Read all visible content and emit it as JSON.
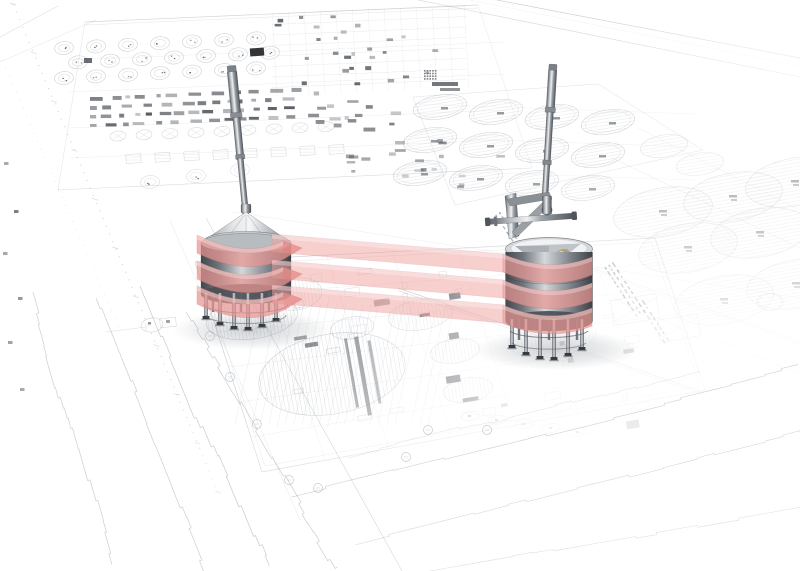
{
  "scene": {
    "type": "3d-architectural-render-over-blueprint",
    "description": "Two stainless steel agitator vessels on support legs, connected and wrapped by three translucent pink ribbon bands, standing on a perspective CAD site blueprint of a tank farm",
    "canvas": {
      "width": 800,
      "height": 571
    },
    "background": "#ffffff",
    "annotations_legible": false
  },
  "colors": {
    "blueprint_line": "#98a0aa",
    "blueprint_dark": "#3c4149",
    "ribbon_fill": "#f0a4a1",
    "ribbon_edge": "#c96f6d",
    "ribbon_opacity": 0.64,
    "metal_dark": "#4a4f55",
    "metal_mid": "#9aa0a6",
    "metal_light": "#eceef0",
    "brass": "#b39b6d",
    "shadow": "#6a7079"
  },
  "ribbon": {
    "band_height": 18,
    "front_sag": 20,
    "bands": [
      {
        "left_top_y": 233,
        "right_top_y": 252
      },
      {
        "left_top_y": 259,
        "right_top_y": 278
      },
      {
        "left_top_y": 284,
        "right_top_y": 303
      }
    ]
  },
  "left_vessel": {
    "cx": 246,
    "mast_top_y": 68,
    "cone_apex_y": 212,
    "rim_y": 241,
    "body_top_y": 243,
    "body_bottom_y": 294,
    "radius": 45,
    "lean_deg": -5.5,
    "front_leg_x": [
      206,
      220,
      234,
      248,
      262,
      276
    ],
    "front_leg_bottom": [
      316,
      322,
      326,
      327,
      324,
      318
    ],
    "back_leg_x": [
      213,
      241,
      269
    ]
  },
  "right_vessel": {
    "cx": 549,
    "mast_top_y": 66,
    "yoke_y": 196,
    "rim_y": 249,
    "body_bottom_y": 321,
    "radius": 43.5,
    "lean_deg": 3.5,
    "front_leg_x": [
      512,
      526,
      540,
      554,
      568,
      582
    ],
    "front_leg_bottom": [
      345,
      352,
      356,
      357,
      353,
      347
    ],
    "back_leg_x": [
      519,
      549,
      577
    ]
  },
  "blueprint": {
    "tank_grid": {
      "origin_x": 440,
      "origin_y": 107,
      "cols": 4,
      "rows": 3,
      "col_dx": 56,
      "col_dy": 5,
      "row_dx": -10,
      "row_dy": 33,
      "rx": 27,
      "ry": 12
    },
    "large_tanks": [
      {
        "x": 663,
        "y": 212
      },
      {
        "x": 733,
        "y": 197
      },
      {
        "x": 795,
        "y": 182
      },
      {
        "x": 688,
        "y": 248
      },
      {
        "x": 760,
        "y": 233
      },
      {
        "x": 724,
        "y": 300
      },
      {
        "x": 796,
        "y": 284
      }
    ],
    "large_tank_rx": 50,
    "large_tank_ry": 24,
    "plan_circle": {
      "x": 332,
      "y": 374,
      "rx": 74,
      "ry": 40
    },
    "medium_circles": [
      {
        "x": 352,
        "y": 328,
        "rx": 22,
        "ry": 11
      },
      {
        "x": 420,
        "y": 315,
        "rx": 32,
        "ry": 15
      },
      {
        "x": 455,
        "y": 351,
        "rx": 25,
        "ry": 12
      },
      {
        "x": 468,
        "y": 390,
        "rx": 25,
        "ry": 12
      },
      {
        "x": 296,
        "y": 294,
        "rx": 26,
        "ry": 16
      }
    ],
    "grid_bubbles": [
      [
        210,
        336
      ],
      [
        230,
        377
      ],
      [
        257,
        424
      ],
      [
        289,
        480
      ],
      [
        318,
        488
      ],
      [
        406,
        457
      ],
      [
        428,
        430
      ],
      [
        487,
        430
      ]
    ]
  }
}
